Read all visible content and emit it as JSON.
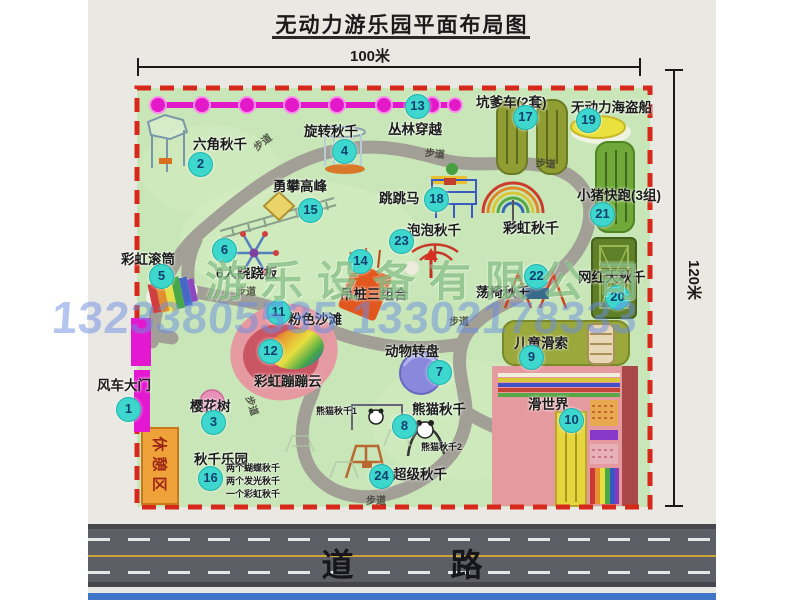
{
  "title": "无动力游乐园平面布局图",
  "dimensions": {
    "width_label": "100米",
    "height_label": "120米"
  },
  "road_label": "道 路",
  "walkway_label": "步道",
  "rest_area_label": "休憩区",
  "watermark": {
    "company": "游乐设备有限公司",
    "phone": "13233805535 13302178333"
  },
  "colors": {
    "park_green": "#c8e6b7",
    "border_red": "#d7281c",
    "badge_cyan": "#3ed7ce",
    "path_gray": "#a19f96",
    "gate_magenta": "#e318c9",
    "road_gray": "#5e5e67"
  },
  "attractions": [
    {
      "num": "1",
      "label": "风车大门",
      "lx": 97,
      "ly": 374,
      "bx": 128,
      "by": 409
    },
    {
      "num": "2",
      "label": "六角秋千",
      "lx": 193,
      "ly": 133,
      "bx": 200,
      "by": 164
    },
    {
      "num": "3",
      "label": "樱花树",
      "lx": 190,
      "ly": 395,
      "bx": 213,
      "by": 422
    },
    {
      "num": "4",
      "label": "旋转秋千",
      "lx": 304,
      "ly": 120,
      "bx": 344,
      "by": 151
    },
    {
      "num": "5",
      "label": "彩虹滚筒",
      "lx": 121,
      "ly": 248,
      "bx": 161,
      "by": 276
    },
    {
      "num": "6",
      "label": "6人跷跷板",
      "lx": 216,
      "ly": 262,
      "bx": 224,
      "by": 250
    },
    {
      "num": "7",
      "label": "动物转盘",
      "lx": 385,
      "ly": 340,
      "bx": 439,
      "by": 372
    },
    {
      "num": "8",
      "label": "熊猫秋千",
      "lx": 412,
      "ly": 398,
      "bx": 404,
      "by": 426
    },
    {
      "num": "9",
      "label": "儿童滑索",
      "lx": 514,
      "ly": 332,
      "bx": 531,
      "by": 357
    },
    {
      "num": "10",
      "label": "滑世界",
      "lx": 528,
      "ly": 393,
      "bx": 571,
      "by": 420
    },
    {
      "num": "11",
      "label": "粉色沙滩",
      "lx": 288,
      "ly": 308,
      "bx": 278,
      "by": 312
    },
    {
      "num": "12",
      "label": "彩虹蹦蹦云",
      "lx": 254,
      "ly": 370,
      "bx": 270,
      "by": 351
    },
    {
      "num": "13",
      "label": "丛林穿越",
      "lx": 388,
      "ly": 118,
      "bx": 417,
      "by": 106
    },
    {
      "num": "14",
      "label": "吊桩三组合",
      "lx": 340,
      "ly": 283,
      "bx": 360,
      "by": 261
    },
    {
      "num": "15",
      "label": "勇攀高峰",
      "lx": 273,
      "ly": 175,
      "bx": 310,
      "by": 210
    },
    {
      "num": "16",
      "label": "秋千乐园",
      "lx": 194,
      "ly": 448,
      "bx": 210,
      "by": 478
    },
    {
      "num": "17",
      "label": "坑爹车(2套)",
      "lx": 476,
      "ly": 91,
      "bx": 525,
      "by": 117
    },
    {
      "num": "18",
      "label": "跳跳马",
      "lx": 379,
      "ly": 187,
      "bx": 436,
      "by": 199
    },
    {
      "num": "19",
      "label": "无动力海盗船",
      "lx": 571,
      "ly": 96,
      "bx": 588,
      "by": 120
    },
    {
      "num": "20",
      "label": "网红大秋千",
      "lx": 578,
      "ly": 266,
      "bx": 617,
      "by": 297
    },
    {
      "num": "21",
      "label": "小猪快跑(3组)",
      "lx": 577,
      "ly": 184,
      "bx": 602,
      "by": 214
    },
    {
      "num": "22",
      "label": "荡椅秋千",
      "lx": 476,
      "ly": 281,
      "bx": 536,
      "by": 276
    },
    {
      "num": "23",
      "label": "泡泡秋千",
      "lx": 407,
      "ly": 219,
      "bx": 401,
      "by": 241
    },
    {
      "num": "24",
      "label": "超级秋千",
      "lx": 393,
      "ly": 463,
      "bx": 381,
      "by": 476
    }
  ],
  "extra_labels": [
    {
      "text": "彩虹秋千",
      "x": 503,
      "y": 218,
      "size": 14
    },
    {
      "text": "熊猫秋千1",
      "x": 316,
      "y": 404,
      "size": 9
    },
    {
      "text": "熊猫秋千2",
      "x": 421,
      "y": 440,
      "size": 9
    },
    {
      "text": "两个蝴蝶秋千",
      "x": 226,
      "y": 461,
      "size": 9
    },
    {
      "text": "两个发光秋千",
      "x": 226,
      "y": 474,
      "size": 9
    },
    {
      "text": "一个彩虹秋千",
      "x": 226,
      "y": 487,
      "size": 9
    }
  ],
  "walkway_positions": [
    {
      "x": 252,
      "y": 134,
      "r": -38
    },
    {
      "x": 425,
      "y": 145,
      "r": 6
    },
    {
      "x": 536,
      "y": 155,
      "r": 4
    },
    {
      "x": 236,
      "y": 283,
      "r": 0
    },
    {
      "x": 449,
      "y": 313,
      "r": 0
    },
    {
      "x": 243,
      "y": 398,
      "r": 72
    },
    {
      "x": 366,
      "y": 492,
      "r": 0
    }
  ]
}
